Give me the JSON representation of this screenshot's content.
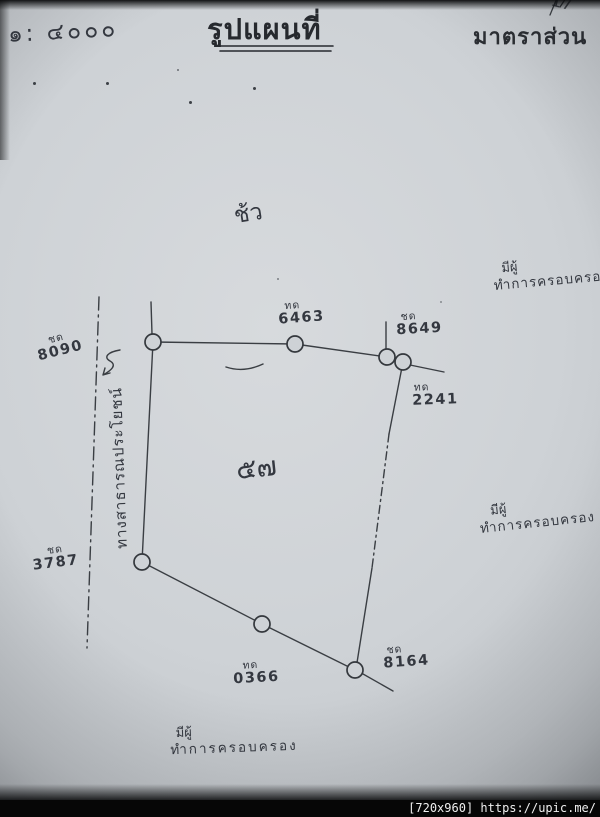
{
  "header": {
    "ratio": "๑: ๔๐๐๐",
    "title": "รูปแผนที่",
    "scale_label": "มาตราส่วน",
    "corner_mark": "17"
  },
  "plan": {
    "orientation_mark": "ช้ว",
    "parcel_number": "๕๗",
    "road_label": "ทางสาธารณประโยชน์",
    "markers": [
      {
        "prefix": "ทด",
        "number": "6463"
      },
      {
        "prefix": "ชด",
        "number": "8649"
      },
      {
        "prefix": "ทด",
        "number": "2241"
      },
      {
        "prefix": "ชด",
        "number": "8164"
      },
      {
        "prefix": "ทด",
        "number": "0366"
      },
      {
        "prefix": "ชด",
        "number": "3787"
      },
      {
        "prefix": "ชด",
        "number": "8090"
      }
    ],
    "adjacent_notes": [
      {
        "line1": "มีผู้",
        "line2": "ทำการครอบครอง"
      },
      {
        "line1": "มีผู้",
        "line2": "ทำการครอบครอง"
      },
      {
        "line1": "มีผู้",
        "line2": "ทำการครอบครอง"
      }
    ]
  },
  "watermark": {
    "text": "[720x960] https://upic.me/"
  },
  "colors": {
    "paper": "#ccd0d4",
    "ink": "#383c42",
    "bar": "#060606"
  }
}
